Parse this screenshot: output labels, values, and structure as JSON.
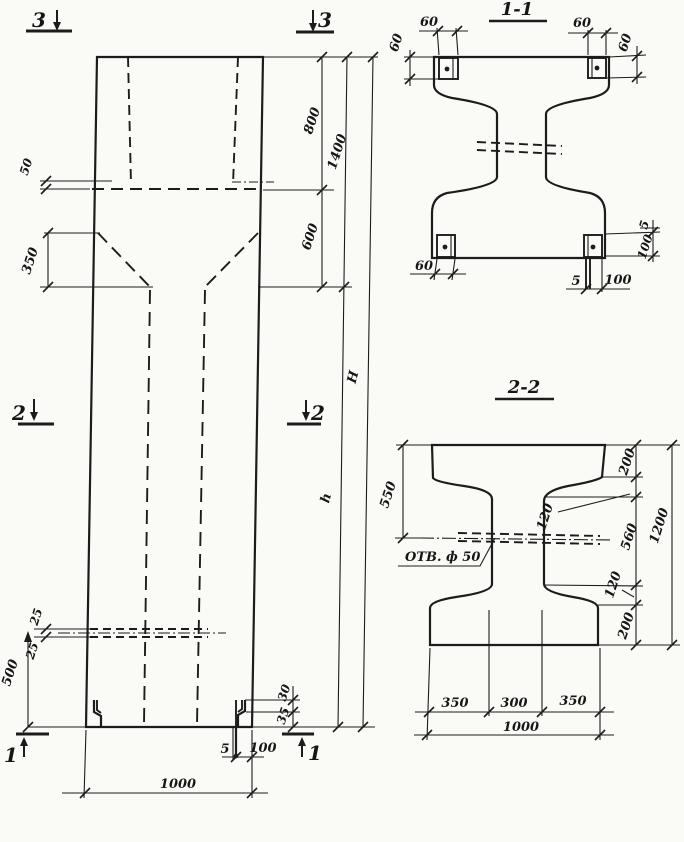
{
  "drawing_kind": "concrete column working drawing (elevation with section cuts and two cross sections)",
  "colors": {
    "ink": "#1c1c1c",
    "paper": "#fafaf7"
  },
  "elevation": {
    "marker_3_left": "3",
    "marker_3_right": "3",
    "marker_2_left": "2",
    "marker_2_right": "2",
    "marker_1_left": "1",
    "marker_1_right": "1",
    "dim_step_50": "50",
    "dim_taper_350": "350",
    "dim_top_800": "800",
    "dim_top_total_1400": "1400",
    "dim_mid_600": "600",
    "dim_total_height": "H",
    "dim_shaft_height": "h",
    "dim_hole_25_top": "25",
    "dim_hole_25_bottom": "25",
    "dim_hole_level_500": "500",
    "dim_base_30": "30",
    "dim_base_35": "35",
    "dim_base_plate_5": "5",
    "dim_base_plate_100": "100",
    "dim_width_1000": "1000"
  },
  "section_1_1": {
    "title": "1-1",
    "dim_60_top_left_v": "60",
    "dim_60_top_left_h": "60",
    "dim_60_top_right_h": "60",
    "dim_60_top_right_v": "60",
    "dim_60_bottom_left": "60",
    "dim_plate_5_bottom": "5",
    "dim_plate_100_bottom": "100",
    "dim_plate_5_right": "5",
    "dim_plate_100_right": "100"
  },
  "section_2_2": {
    "title": "2-2",
    "dim_550": "550",
    "hole_label": "ОТВ. ф 50",
    "dim_flange_200_top": "200",
    "dim_taper_120_top": "120",
    "dim_web_560": "560",
    "dim_taper_120_bottom": "120",
    "dim_flange_200_bottom": "200",
    "dim_total_1200": "1200",
    "dim_350_left": "350",
    "dim_300_center": "300",
    "dim_350_right": "350",
    "dim_total_1000": "1000"
  }
}
